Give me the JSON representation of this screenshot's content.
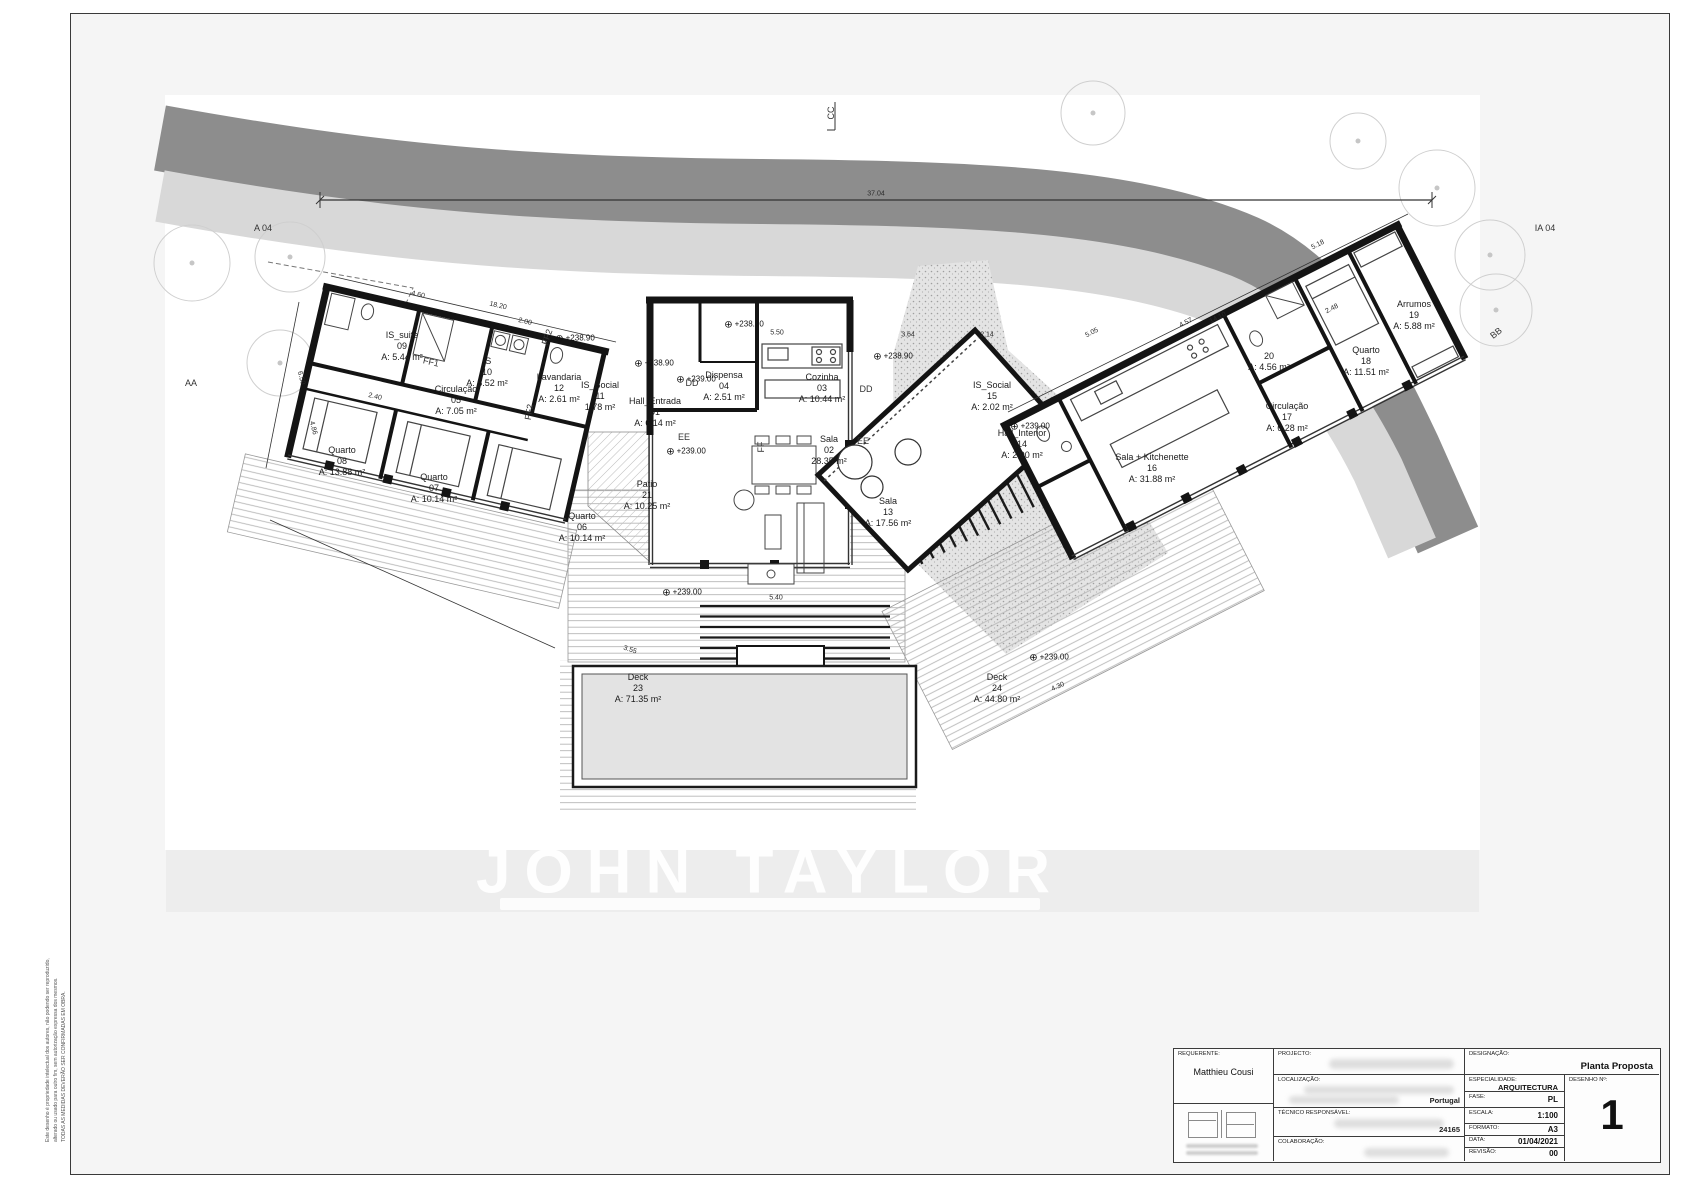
{
  "drawing": {
    "elevation_symbol": "⊕",
    "watermark": "JOHN TAYLOR",
    "markers": {
      "a04": "A 04",
      "ia04": "IA 04",
      "cc": "CC",
      "aa": "AA",
      "bb": "BB",
      "dd": "DD",
      "ee": "EE",
      "ff": "FF",
      "ff1": "FF1",
      "ff2": "FF2"
    },
    "rooms": [
      {
        "name": "Hall_Entrada",
        "number": "01",
        "area": "A:   6.14 m²"
      },
      {
        "name": "Sala",
        "number": "02",
        "area": "28.35 m²"
      },
      {
        "name": "Cozinha",
        "number": "03",
        "area": "A: 10.44 m²"
      },
      {
        "name": "Dispensa",
        "number": "04",
        "area": "A: 2.51 m²"
      },
      {
        "name": "Circulação",
        "number": "05",
        "area": "A: 7.05 m²"
      },
      {
        "name": "Quarto",
        "number": "06",
        "area": "A: 10.14 m²"
      },
      {
        "name": "Quarto",
        "number": "07",
        "area": "A: 10.14 m²"
      },
      {
        "name": "Quarto",
        "number": "08",
        "area": "A: 13.88 m²"
      },
      {
        "name": "IS_suite",
        "number": "09",
        "area": "A: 5.44 m²"
      },
      {
        "name": "IS",
        "number": "10",
        "area": "A: 5.52 m²"
      },
      {
        "name": "IS_Social",
        "number": "11",
        "area": "1.78 m²"
      },
      {
        "name": "Lavandaria",
        "number": "12",
        "area": "A: 2.61 m²"
      },
      {
        "name": "Sala",
        "number": "13",
        "area": "A: 17.56 m²"
      },
      {
        "name": "Hall_Interior",
        "number": "14",
        "area": "A:   2.90 m²"
      },
      {
        "name": "IS_Social",
        "number": "15",
        "area": "A: 2.02 m²"
      },
      {
        "name": "Sala + Kitchenette",
        "number": "16",
        "area": "A:      31.88 m²"
      },
      {
        "name": "Circulação",
        "number": "17",
        "area": "A:  6.28 m²"
      },
      {
        "name": "Quarto",
        "number": "18",
        "area": "A: 11.51 m²"
      },
      {
        "name": "Arrumos",
        "number": "19",
        "area": "A: 5.88 m²"
      },
      {
        "name": "IS",
        "number": "20",
        "area": "A: 4.56 m²"
      },
      {
        "name": "Patio",
        "number": "21",
        "area": "A: 10.25 m²"
      },
      {
        "name": "Deck",
        "number": "23",
        "area": "A: 71.35 m²"
      },
      {
        "name": "Deck",
        "number": "24",
        "area": "A: 44.80 m²"
      }
    ],
    "levels": [
      "+238.70",
      "+238.90",
      "+238.90",
      "+238.90",
      "+239.00",
      "+239.00",
      "+239.00",
      "+239.00",
      "+239.00"
    ],
    "dims": [
      "37.04",
      "4.60",
      "18.20",
      "2.00",
      "5.50",
      "3.64",
      "2.14",
      "5.05",
      "4.57",
      "14.10",
      "5.18",
      "5.20",
      "0.30",
      "6.50",
      "4.86",
      "5.40",
      "3.55",
      "2.40",
      "4.30",
      "2.48"
    ],
    "side_note": [
      "Este desenho é propriedade intelectual dos autores, não podendo ser reproduzido,",
      "alterado ou usado para outro fim, sem autorização expressa dos mesmos.",
      "TODAS AS MEDIDAS DEVERÃO SER CONFIRMADAS EM OBRA."
    ]
  },
  "titleblock": {
    "requerente_label": "REQUERENTE:",
    "requerente": "Matthieu Cousi",
    "projecto_label": "PROJECTO:",
    "localizacao_label": "LOCALIZAÇÃO:",
    "localizacao_suffix": "Portugal",
    "tecnico_label": "TÉCNICO RESPONSÁVEL:",
    "tecnico_suffix": "24165",
    "colaboracao_label": "COLABORAÇÃO:",
    "designacao_label": "DESIGNAÇÃO:",
    "designacao": "Planta Proposta",
    "especialidade_label": "ESPECIALIDADE:",
    "especialidade": "ARQUITECTURA",
    "fase_label": "FASE:",
    "fase": "PL",
    "escala_label": "ESCALA:",
    "escala": "1:100",
    "formato_label": "FORMATO:",
    "formato": "A3",
    "data_label": "DATA:",
    "data": "01/04/2021",
    "revisao_label": "REVISÃO:",
    "revisao": "00",
    "desenho_label": "DESENHO Nº:",
    "desenho": "1"
  }
}
